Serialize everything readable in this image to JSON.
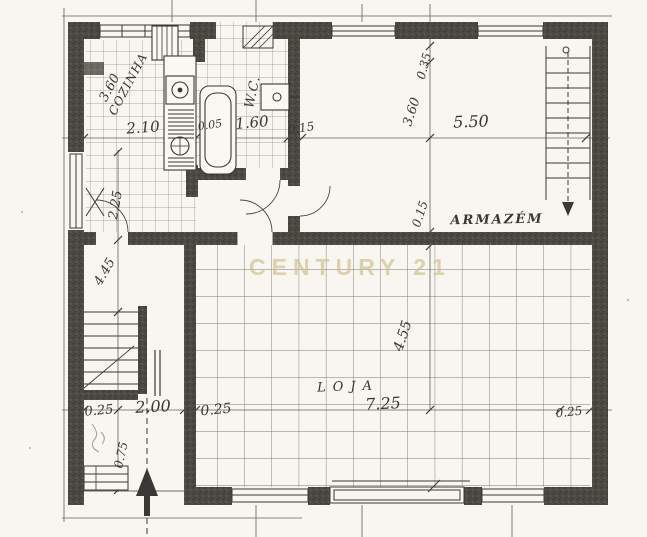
{
  "plan": {
    "watermark": {
      "text": "CENTURY 21",
      "color": "#ccbd88"
    },
    "ink_color": "#3a3834",
    "rooms": {
      "cozinha": "COZINHA",
      "wc": "W.C.",
      "armazem": "ARMAZÉM",
      "loja": "LOJA"
    },
    "dims": {
      "cozinha_depth": "3.60",
      "cozinha_width": "2.10",
      "gap_kitchen_wc": "0.05",
      "wc_width": "1.60",
      "wall_wc_armazem": "0.15",
      "armazem_width": "5.50",
      "armazem_offset": "0.35",
      "armazem_depth": "3.60",
      "mid_wall": "0.15",
      "left_room_depth": "2.25",
      "hall_depth": "4.45",
      "loja_depth": "4.55",
      "loja_width": "7.25",
      "entry_wall_left": "0.25",
      "entry_width": "2.00",
      "entry_wall_right": "0.25",
      "right_offset": "0.25",
      "entry_step": "0.75"
    }
  }
}
